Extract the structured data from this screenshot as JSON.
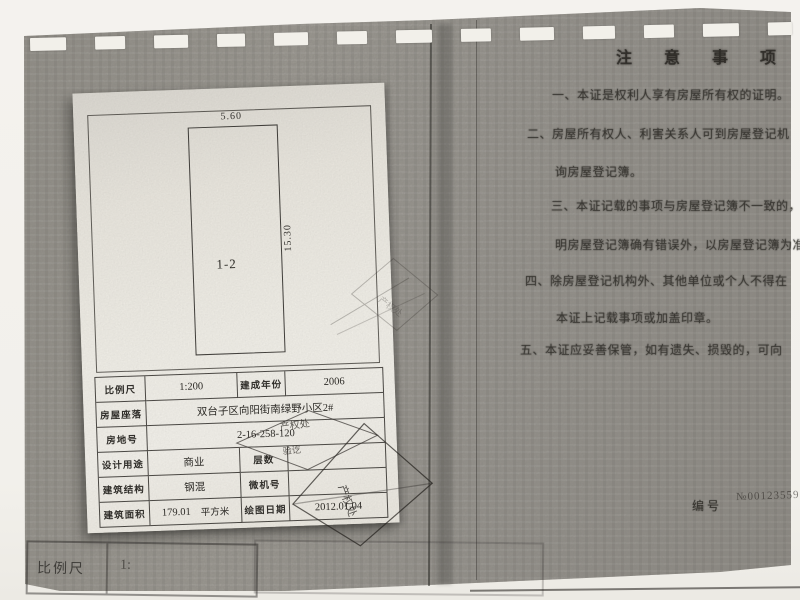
{
  "paper": {
    "plan": {
      "width_dim": "5.60",
      "height_dim": "15.30",
      "unit_label": "1-2"
    },
    "table": {
      "rows": [
        {
          "cells": [
            {
              "t": "比例尺",
              "w": "l"
            },
            {
              "t": "1:200",
              "w": "v"
            },
            {
              "t": "建成年份",
              "w": "l"
            },
            {
              "t": "2006",
              "w": "v"
            }
          ]
        },
        {
          "cells": [
            {
              "t": "房屋座落",
              "w": "l"
            },
            {
              "t": "双台子区向阳街南绿野小区2#",
              "w": "v",
              "span": 3
            }
          ]
        },
        {
          "cells": [
            {
              "t": "房地号",
              "w": "l"
            },
            {
              "t": "2-16-258-120",
              "w": "v",
              "span": 3
            }
          ]
        },
        {
          "cells": [
            {
              "t": "设计用途",
              "w": "l"
            },
            {
              "t": "商业",
              "w": "v"
            },
            {
              "t": "层数",
              "w": "l"
            },
            {
              "t": "",
              "w": "v"
            }
          ]
        },
        {
          "cells": [
            {
              "t": "建筑结构",
              "w": "l"
            },
            {
              "t": "钢混",
              "w": "v"
            },
            {
              "t": "微机号",
              "w": "l"
            },
            {
              "t": "",
              "w": "v"
            }
          ]
        },
        {
          "cells": [
            {
              "t": "建筑面积",
              "w": "l"
            },
            {
              "t": "179.01",
              "unit": "平方米",
              "w": "v"
            },
            {
              "t": "绘图日期",
              "w": "l"
            },
            {
              "t": "2012.01.04",
              "w": "v"
            }
          ]
        }
      ]
    },
    "stamps": [
      {
        "text": "产权处"
      },
      {
        "text": "验讫"
      },
      {
        "text": "产权处"
      },
      {
        "text": "产权处"
      }
    ]
  },
  "notes": {
    "title": "注 意 事 项",
    "lines": [
      {
        "text": "一、本证是权利人享有房屋所有权的证明。"
      },
      {
        "text": "二、房屋所有权人、利害关系人可到房屋登记机"
      },
      {
        "text": "询房屋登记簿。"
      },
      {
        "text": "三、本证记载的事项与房屋登记簿不一致的，除"
      },
      {
        "text": "明房屋登记簿确有错误外，以房屋登记簿为准。"
      },
      {
        "text": "四、除房屋登记机构外、其他单位或个人不得在"
      },
      {
        "text": "本证上记载事项或加盖印章。"
      },
      {
        "text": "五、本证应妥善保管，如有遗失、损毁的，可向"
      }
    ]
  },
  "serial": {
    "label": "编号",
    "number": "№00123559"
  },
  "ghost_table": {
    "label": "比例尺",
    "value": "1:"
  },
  "colors": {
    "page": "#93908a",
    "paper": "#eae7e0",
    "ink": "#2c2b27"
  }
}
